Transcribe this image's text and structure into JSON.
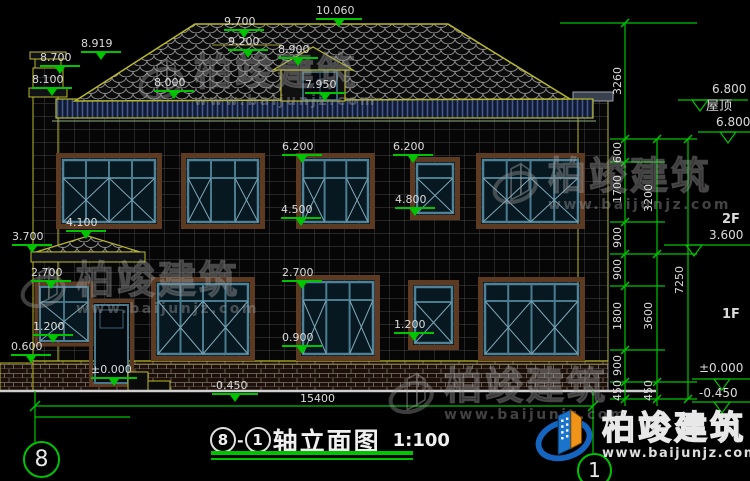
{
  "title": {
    "axis_start": "8",
    "axis_end": "1",
    "separator": "-",
    "text": "轴立面图",
    "scale": "1:100"
  },
  "axis": {
    "left_bubble": "8",
    "right_bubble": "1"
  },
  "watermark": {
    "brand": "柏竣建筑",
    "url": "www.baijunjz.com"
  },
  "logo": {
    "brand": "柏竣建筑",
    "url": "www.baijunjz.com"
  },
  "colors": {
    "dim_green": "#00c400",
    "outline_yellow": "#b9b92a",
    "text": "#dcdcdc",
    "window_frame": "#4e8298",
    "eave_band": "#101a33",
    "logo_blue": "#1a74cc",
    "logo_orange": "#ef9418"
  },
  "labels": [
    {
      "t": "8.919",
      "x": 81,
      "y": 38,
      "mk": 1
    },
    {
      "t": "8.700",
      "x": 40,
      "y": 52,
      "mk": 1
    },
    {
      "t": "8.100",
      "x": 32,
      "y": 74,
      "mk": 1
    },
    {
      "t": "9.700",
      "x": 224,
      "y": 16,
      "mk": 1
    },
    {
      "t": "10.060",
      "x": 316,
      "y": 5,
      "mk": 1,
      "w": 46
    },
    {
      "t": "9.200",
      "x": 228,
      "y": 36,
      "mk": 1
    },
    {
      "t": "8.900",
      "x": 278,
      "y": 44,
      "mk": 1
    },
    {
      "t": "8.000",
      "x": 154,
      "y": 77,
      "mk": 1
    },
    {
      "t": "7.950",
      "x": 305,
      "y": 79,
      "mk": 1
    },
    {
      "t": "6.200",
      "x": 282,
      "y": 141,
      "mk": 1
    },
    {
      "t": "6.200",
      "x": 393,
      "y": 141,
      "mk": 1
    },
    {
      "t": "4.500",
      "x": 281,
      "y": 204,
      "mk": 1
    },
    {
      "t": "4.800",
      "x": 395,
      "y": 194,
      "mk": 1
    },
    {
      "t": "4.100",
      "x": 66,
      "y": 217,
      "mk": 1
    },
    {
      "t": "3.700",
      "x": 12,
      "y": 231,
      "mk": 1
    },
    {
      "t": "2.700",
      "x": 31,
      "y": 267,
      "mk": 1
    },
    {
      "t": "2.700",
      "x": 282,
      "y": 267,
      "mk": 1
    },
    {
      "t": "1.200",
      "x": 33,
      "y": 321,
      "mk": 1
    },
    {
      "t": "1.200",
      "x": 394,
      "y": 319,
      "mk": 1
    },
    {
      "t": "0.900",
      "x": 282,
      "y": 332,
      "mk": 1
    },
    {
      "t": "0.600",
      "x": 11,
      "y": 341,
      "mk": 1
    },
    {
      "t": "±0.000",
      "x": 91,
      "y": 364,
      "mk": 1,
      "w": 46
    },
    {
      "t": "-0.450",
      "x": 212,
      "y": 380,
      "mk": 1,
      "w": 46
    },
    {
      "t": "15400",
      "x": 300,
      "y": 393,
      "n": "overall-dimension"
    },
    {
      "t": "3260",
      "x": 612,
      "y": 95,
      "v": 1,
      "n": "chain-dim"
    },
    {
      "t": "600",
      "x": 612,
      "y": 163,
      "v": 1,
      "n": "chain-dim"
    },
    {
      "t": "1700",
      "x": 612,
      "y": 203,
      "v": 1,
      "n": "chain-dim"
    },
    {
      "t": "900",
      "x": 612,
      "y": 248,
      "v": 1,
      "n": "chain-dim"
    },
    {
      "t": "900",
      "x": 612,
      "y": 280,
      "v": 1,
      "n": "chain-dim"
    },
    {
      "t": "1800",
      "x": 612,
      "y": 330,
      "v": 1,
      "n": "chain-dim"
    },
    {
      "t": "900",
      "x": 612,
      "y": 376,
      "v": 1,
      "n": "chain-dim"
    },
    {
      "t": "450",
      "x": 612,
      "y": 401,
      "v": 1,
      "n": "chain-dim"
    },
    {
      "t": "3200",
      "x": 643,
      "y": 212,
      "v": 1,
      "n": "chain-dim"
    },
    {
      "t": "3600",
      "x": 643,
      "y": 330,
      "v": 1,
      "n": "chain-dim"
    },
    {
      "t": "450",
      "x": 643,
      "y": 401,
      "v": 1,
      "n": "chain-dim"
    },
    {
      "t": "7250",
      "x": 674,
      "y": 294,
      "v": 1,
      "n": "chain-dim"
    },
    {
      "t": "6.800",
      "x": 712,
      "y": 83,
      "s": 12,
      "n": "level-label"
    },
    {
      "t": "屋顶",
      "x": 706,
      "y": 100,
      "s": 13,
      "n": "level-label"
    },
    {
      "t": "6.800",
      "x": 716,
      "y": 116,
      "s": 12,
      "n": "level-label"
    },
    {
      "t": "2F",
      "x": 722,
      "y": 213,
      "s": 13,
      "b": 1,
      "n": "floor-label"
    },
    {
      "t": "3.600",
      "x": 709,
      "y": 229,
      "s": 12,
      "n": "level-label"
    },
    {
      "t": "1F",
      "x": 722,
      "y": 308,
      "s": 13,
      "b": 1,
      "n": "floor-label"
    },
    {
      "t": "±0.000",
      "x": 699,
      "y": 362,
      "s": 12,
      "n": "level-label"
    },
    {
      "t": "-0.450",
      "x": 699,
      "y": 387,
      "s": 12,
      "n": "level-label"
    }
  ]
}
